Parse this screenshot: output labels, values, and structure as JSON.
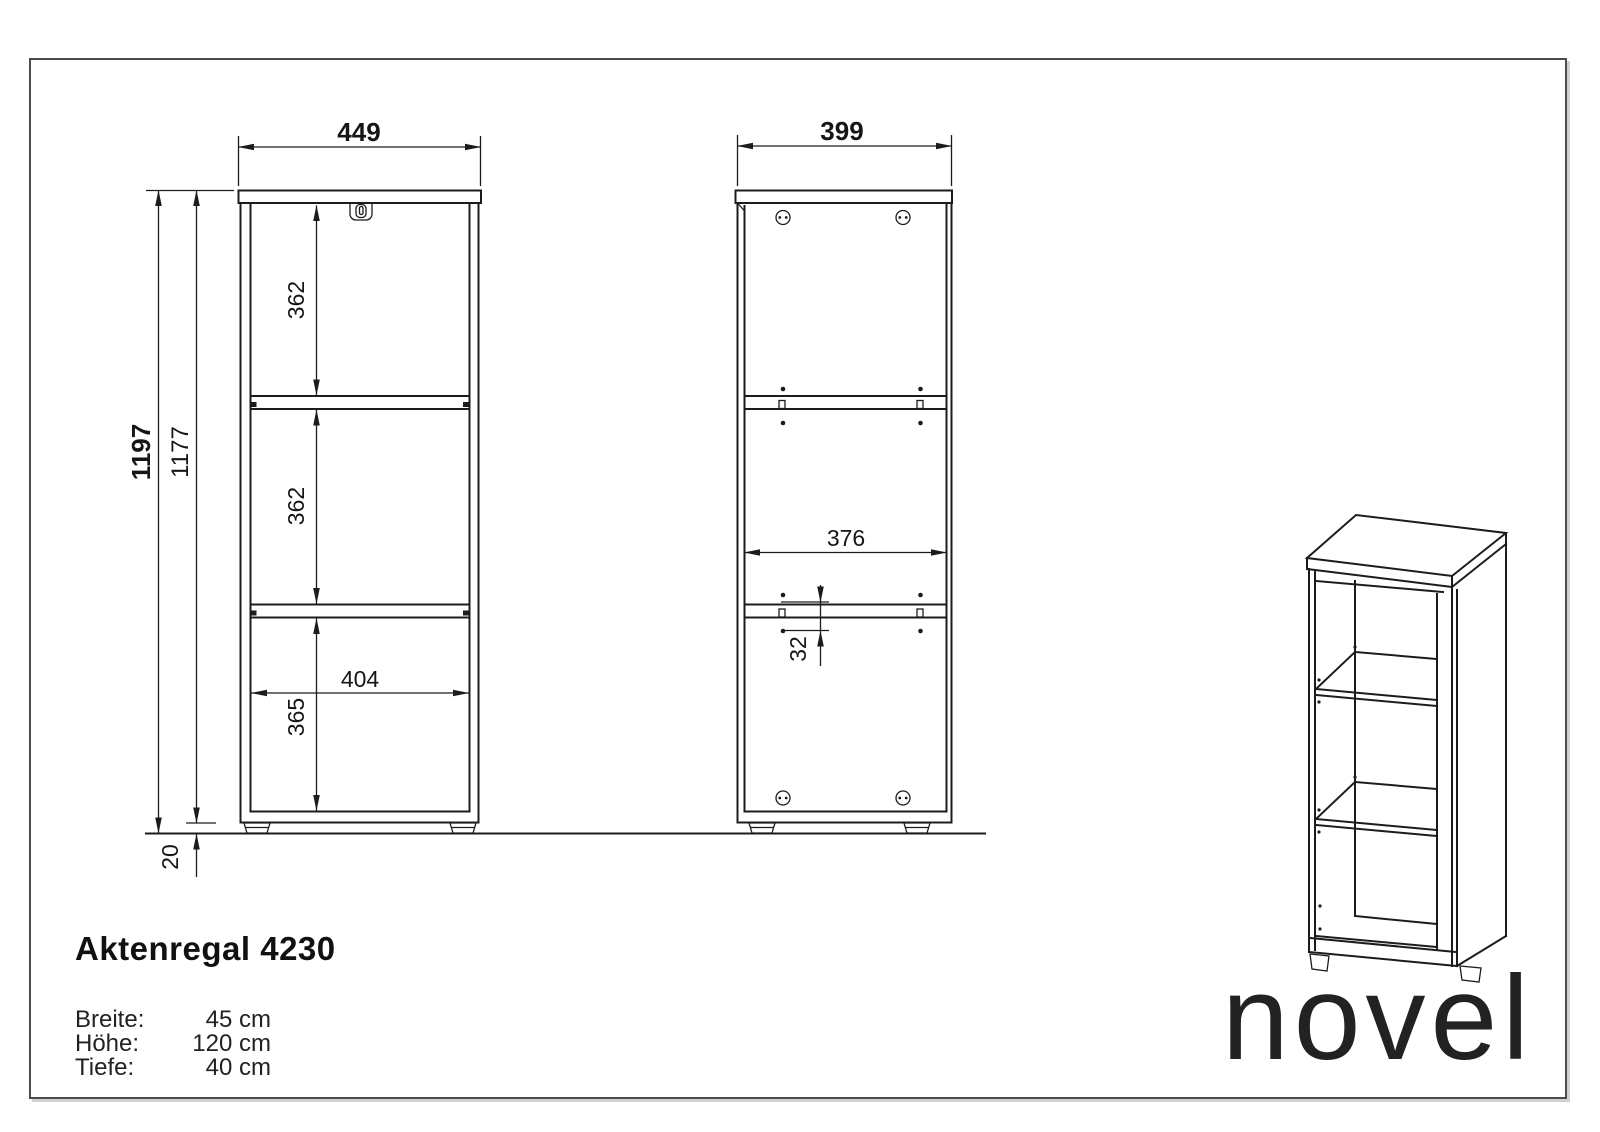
{
  "colors": {
    "ink": "#1c1c1c",
    "frame": "#4b4b4b",
    "paper": "#ffffff"
  },
  "views": {
    "front": {
      "width": "449",
      "height_total": "1197",
      "height_body": "1177",
      "compartment_top": "362",
      "compartment_middle": "362",
      "compartment_bottom_height": "365",
      "inner_width": "404",
      "foot_height": "20"
    },
    "side": {
      "depth": "399",
      "inner_depth": "376",
      "hole_spacing": "32"
    }
  },
  "title_block": {
    "product": "Aktenregal 4230",
    "specs": [
      {
        "label": "Breite:",
        "value": "45 cm"
      },
      {
        "label": "Höhe:",
        "value": "120 cm"
      },
      {
        "label": "Tiefe:",
        "value": "40 cm"
      }
    ]
  },
  "brand": {
    "logo": "novel"
  }
}
